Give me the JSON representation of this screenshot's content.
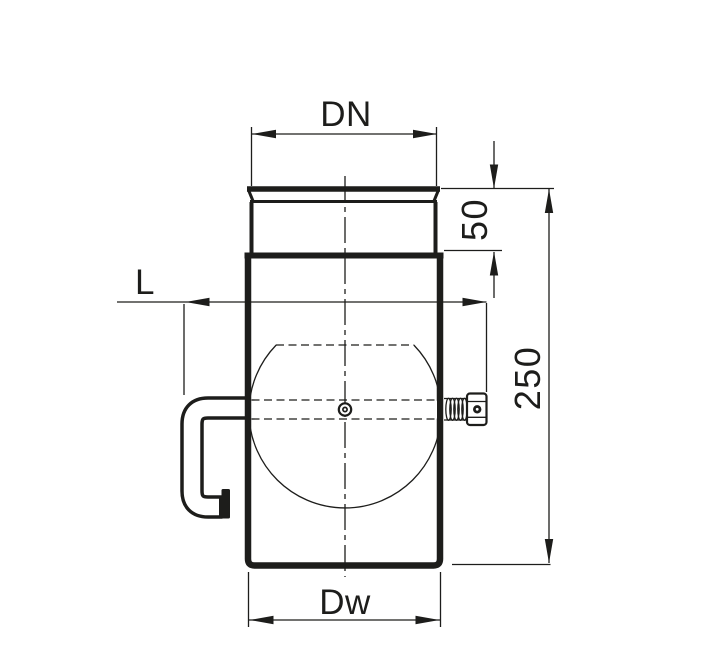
{
  "drawing": {
    "labels": {
      "spigot_diameter": "DN",
      "spigot_height": "50",
      "body_height": "250",
      "handle_offset": "L",
      "body_diameter": "Dw"
    },
    "colors": {
      "line": "#1d1d1b",
      "background": "#ffffff"
    }
  }
}
